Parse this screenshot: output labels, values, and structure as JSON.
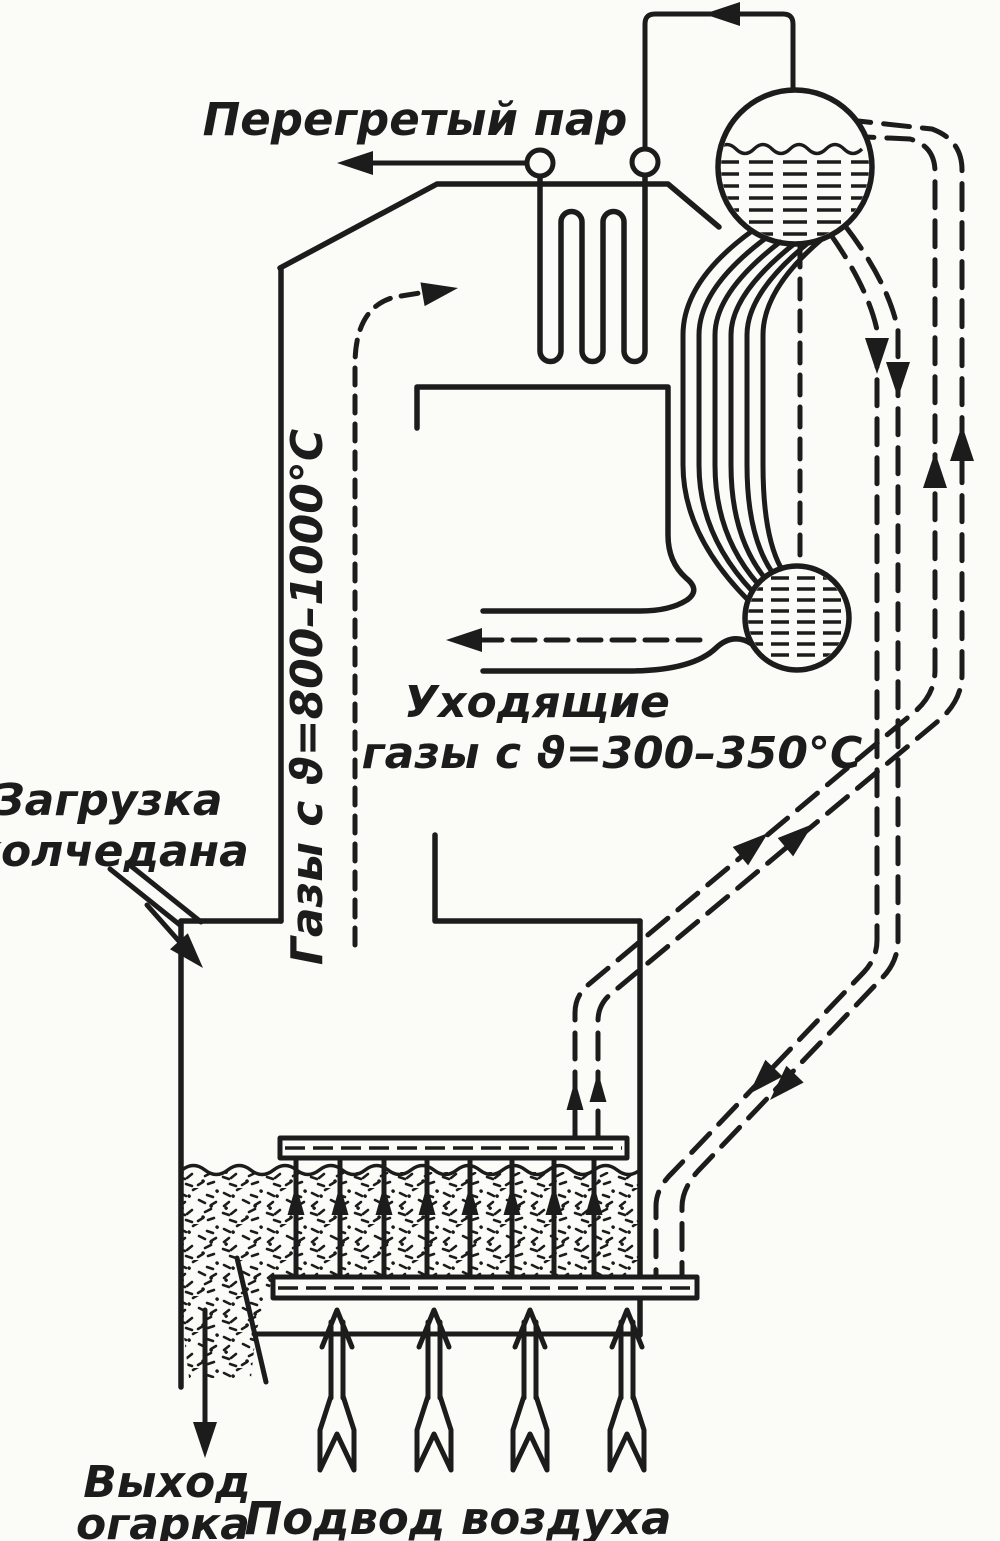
{
  "diagram": {
    "type": "engineering-schematic",
    "subject": "fluidized-bed pyrite roasting furnace with waste-heat boiler",
    "colors": {
      "ink": "#1c1c1c",
      "paper": "#fbfbf8"
    },
    "labels": {
      "superheated_steam": "Перегретый пар",
      "hot_gases": "Газы с ϑ=800–1000°C",
      "exhaust_gases_line1": "Уходящие",
      "exhaust_gases_line2": "газы с ϑ=300–350°C",
      "pyrite_feed_line1": "Загрузка",
      "pyrite_feed_line2": "колчедана",
      "cinder_out_line1": "Выход",
      "cinder_out_line2": "огарка",
      "air_supply": "Подвод воздуха"
    }
  }
}
